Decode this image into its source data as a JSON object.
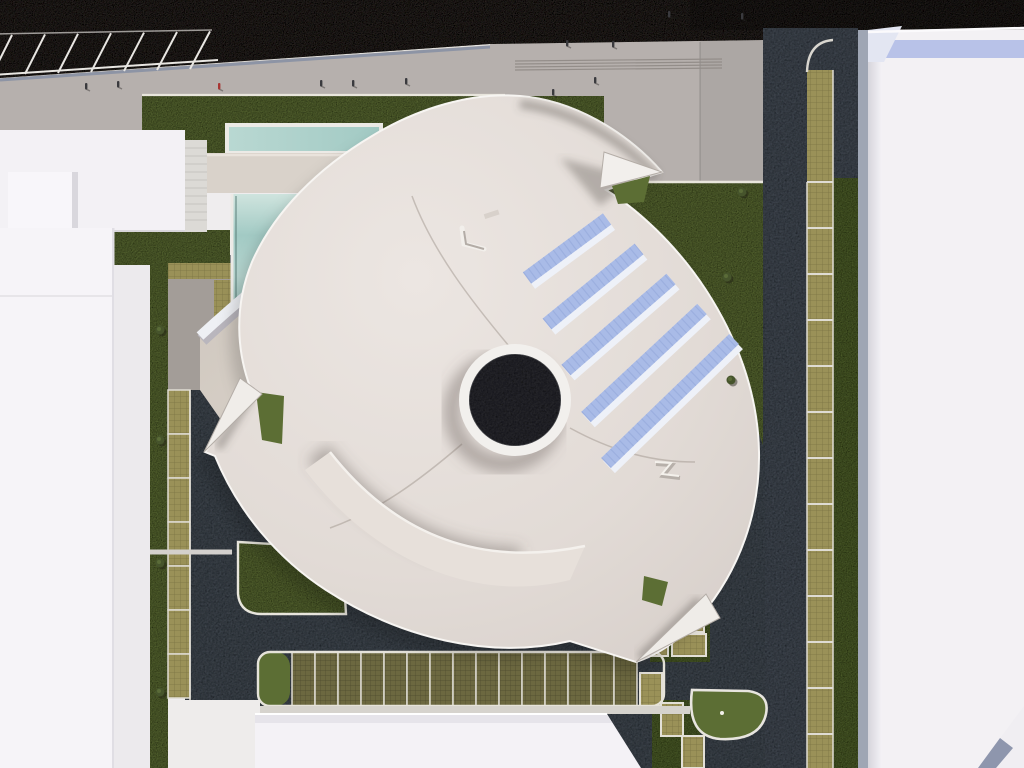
{
  "meta": {
    "title": "Aerial 3D architectural rendering - pinwheel-shaped building site plan",
    "view": "top-down axonometric render",
    "visible_text": "none"
  },
  "palette": {
    "asphalt": "#3a3631",
    "road": "#4b535d",
    "plaza": "#b6b0ad",
    "plaza_dark": "#a8a29f",
    "lawn": "#68793c",
    "lawn_dark": "#5c6e34",
    "curb": "#e9e6dd",
    "white_roof": "#f4f2f6",
    "roof_light": "#ece6e2",
    "roof_dark": "#d6cec9",
    "parapet": "#f6f3f0",
    "teal": "#a2cac4",
    "teal_light": "#cfe4de",
    "beige_bar": "#d9d2ca",
    "path_beige": "#d2cbc2",
    "khaki": "#9a9158",
    "olive": "#6c6840",
    "solar": "#a9bbe7",
    "solar_rib": "#93a7d9",
    "oculus": "#303337",
    "blue_band": "#b8c2e8",
    "steel": "#9fa6b4",
    "stripe_white": "#e8e6e2",
    "figure_dark": "#3a3a3e",
    "figure_red": "#a83532"
  },
  "site": {
    "top_parking_stripes": {
      "count": 7,
      "x_start": -8,
      "x_step": 33,
      "y_bottom": 75,
      "y_top": 35,
      "lean_dx": 20
    },
    "plaza_steps": {
      "count": 4,
      "x1": 515,
      "x2": 722,
      "y_first": 61,
      "y_step": 3
    },
    "left_planter_cells": {
      "x": 168,
      "width": 22,
      "y_start": 390,
      "step": 44,
      "count": 7
    },
    "right_stall_column": {
      "x": 807,
      "width": 26,
      "y_top": 70,
      "divider_y_start": 182,
      "divider_step": 46,
      "divider_count": 13,
      "y_end": 768
    },
    "bottom_stall_row": {
      "x_start": 292,
      "stall_width": 23,
      "count": 15,
      "y": 652,
      "height": 54
    },
    "stepped_stalls": [
      [
        640,
        673,
        22,
        33
      ],
      [
        661,
        703,
        22,
        33
      ],
      [
        682,
        736,
        22,
        32
      ]
    ],
    "cluster_stalls": [
      [
        632,
        610,
        36,
        46
      ],
      [
        670,
        610,
        34,
        22
      ],
      [
        672,
        634,
        34,
        22
      ]
    ],
    "solar_strips": [
      [
        527,
        278,
        607,
        219
      ],
      [
        547,
        324,
        639,
        249
      ],
      [
        566,
        370,
        671,
        279
      ],
      [
        586,
        417,
        702,
        309
      ],
      [
        606,
        463,
        734,
        339
      ]
    ],
    "pedestrians": [
      {
        "x": 85,
        "y": 86,
        "red": false
      },
      {
        "x": 117,
        "y": 84,
        "red": false
      },
      {
        "x": 218,
        "y": 86,
        "red": true
      },
      {
        "x": 320,
        "y": 83,
        "red": false
      },
      {
        "x": 352,
        "y": 83,
        "red": false
      },
      {
        "x": 405,
        "y": 81,
        "red": false
      },
      {
        "x": 552,
        "y": 92,
        "red": false
      },
      {
        "x": 566,
        "y": 43,
        "red": false
      },
      {
        "x": 594,
        "y": 80,
        "red": false
      },
      {
        "x": 612,
        "y": 44,
        "red": false
      },
      {
        "x": 668,
        "y": 14,
        "red": false
      },
      {
        "x": 741,
        "y": 16,
        "red": false
      }
    ],
    "shrubs": [
      [
        160,
        330
      ],
      [
        160,
        440
      ],
      [
        160,
        563
      ],
      [
        160,
        692
      ],
      [
        742,
        192
      ],
      [
        727,
        277
      ],
      [
        731,
        380
      ]
    ]
  }
}
